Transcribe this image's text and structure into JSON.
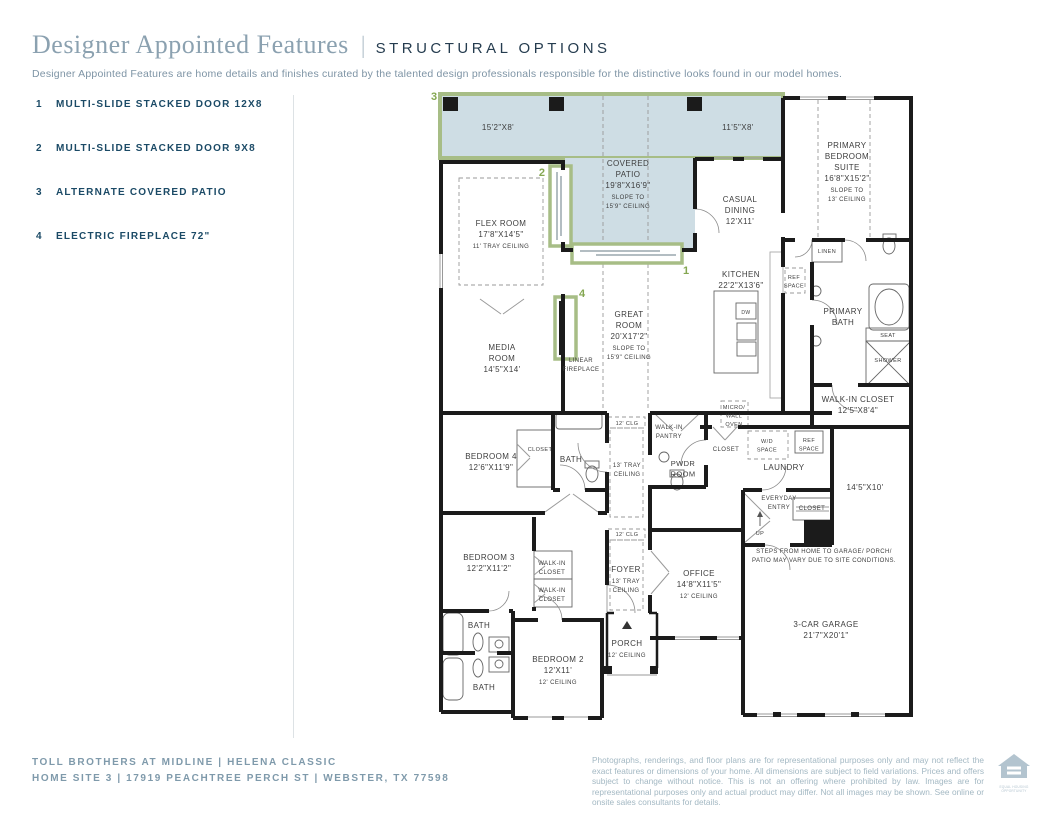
{
  "header": {
    "title": "Designer Appointed Features",
    "divider": "|",
    "tag": "STRUCTURAL OPTIONS",
    "description": "Designer Appointed Features are home details and finishes curated by the talented design professionals responsible for the distinctive looks found in our model homes."
  },
  "legend": {
    "items": [
      {
        "num": "1",
        "label": "MULTI-SLIDE STACKED DOOR 12X8"
      },
      {
        "num": "2",
        "label": "MULTI-SLIDE STACKED DOOR 9X8"
      },
      {
        "num": "3",
        "label": "ALTERNATE COVERED PATIO"
      },
      {
        "num": "4",
        "label": "ELECTRIC FIREPLACE 72\""
      }
    ]
  },
  "footer": {
    "line1": "TOLL BROTHERS AT MIDLINE   |   HELENA CLASSIC",
    "line2": "HOME SITE 3   |   17919 PEACHTREE PERCH ST   |   WEBSTER, TX 77598",
    "disclaimer": "Photographs, renderings, and floor plans are for representational purposes only and may not reflect the exact features or dimensions of your home. All dimensions are subject to field variations. Prices and offers subject to change without notice. This is not an offering where prohibited by law. Images are for representational purposes only and actual product may differ. Not all images may be shown. See online or onsite sales consultants for details.",
    "logo_caption": "EQUAL HOUSING OPPORTUNITY"
  },
  "colors": {
    "accent_navy": "#1b4a66",
    "title_blue": "#8ba1b0",
    "option_green": "#84a751",
    "option_green_border": "#a7bd86",
    "patio_fill": "#cedde4",
    "wall": "#1b1b1b",
    "plan_text": "#3d3d3d"
  },
  "plan": {
    "markers": [
      {
        "n": "1",
        "x": 686,
        "y": 274
      },
      {
        "n": "2",
        "x": 545,
        "y": 176,
        "anchor": "end"
      },
      {
        "n": "3",
        "x": 434,
        "y": 100
      },
      {
        "n": "4",
        "x": 582,
        "y": 297
      }
    ],
    "labels": [
      {
        "id": "alt-patio-left-dim",
        "x": 498,
        "y": 130,
        "lines": [
          "15'2\"X8'"
        ],
        "sizes": [
          8
        ]
      },
      {
        "id": "alt-patio-right-dim",
        "x": 738,
        "y": 130,
        "lines": [
          "11'5\"X8'"
        ],
        "sizes": [
          8
        ]
      },
      {
        "id": "covered-patio",
        "x": 628,
        "y": 166,
        "lines": [
          "COVERED",
          "PATIO",
          "19'8\"X16'9\"",
          "SLOPE TO",
          "15'9\" CEILING"
        ],
        "sizes": [
          8,
          8,
          8,
          6,
          6
        ]
      },
      {
        "id": "flex-room",
        "x": 501,
        "y": 226,
        "lines": [
          "FLEX ROOM",
          "17'8\"X14'5\"",
          "11' TRAY CEILING"
        ],
        "sizes": [
          8,
          8,
          6
        ]
      },
      {
        "id": "casual-dining",
        "x": 740,
        "y": 202,
        "lines": [
          "CASUAL",
          "DINING",
          "12'X11'"
        ],
        "sizes": [
          8,
          8,
          8
        ]
      },
      {
        "id": "primary-bedroom-suite",
        "x": 847,
        "y": 148,
        "lines": [
          "PRIMARY",
          "BEDROOM",
          "SUITE",
          "16'8\"X15'2\"",
          "SLOPE TO",
          "13' CEILING"
        ],
        "sizes": [
          8,
          8,
          8,
          8,
          6,
          6
        ]
      },
      {
        "id": "kitchen",
        "x": 741,
        "y": 277,
        "lines": [
          "KITCHEN",
          "22'2\"X13'6\""
        ],
        "sizes": [
          8,
          8
        ]
      },
      {
        "id": "great-room",
        "x": 629,
        "y": 317,
        "lines": [
          "GREAT",
          "ROOM",
          "20'X17'2\"",
          "SLOPE TO",
          "15'9\" CEILING"
        ],
        "sizes": [
          8,
          8,
          8,
          6,
          6
        ]
      },
      {
        "id": "media-room",
        "x": 502,
        "y": 350,
        "lines": [
          "MEDIA",
          "ROOM",
          "14'5\"X14'"
        ],
        "sizes": [
          8,
          8,
          8
        ]
      },
      {
        "id": "linear-fireplace",
        "x": 581,
        "y": 362,
        "lines": [
          "LINEAR",
          "FIREPLACE"
        ],
        "sizes": [
          6,
          6
        ]
      },
      {
        "id": "linen",
        "x": 827,
        "y": 253,
        "lines": [
          "LINEN"
        ],
        "sizes": [
          5.5
        ]
      },
      {
        "id": "ref-space-kitchen",
        "x": 794,
        "y": 279,
        "lines": [
          "REF",
          "SPACE"
        ],
        "sizes": [
          5.5,
          5.5
        ]
      },
      {
        "id": "primary-bath",
        "x": 843,
        "y": 314,
        "lines": [
          "PRIMARY",
          "BATH"
        ],
        "sizes": [
          8,
          8
        ]
      },
      {
        "id": "seat",
        "x": 888,
        "y": 337,
        "lines": [
          "SEAT"
        ],
        "sizes": [
          5.5
        ]
      },
      {
        "id": "shower",
        "x": 888,
        "y": 362,
        "lines": [
          "SHOWER"
        ],
        "sizes": [
          5.5
        ]
      },
      {
        "id": "walk-in-closet-primary",
        "x": 858,
        "y": 402,
        "lines": [
          "WALK-IN CLOSET",
          "12'5\"X8'4\""
        ],
        "sizes": [
          8,
          8
        ]
      },
      {
        "id": "micro-wall-oven",
        "x": 734,
        "y": 409,
        "lines": [
          "MICRO/",
          "WALL",
          "OVEN"
        ],
        "sizes": [
          5.5,
          5.5,
          5.5
        ]
      },
      {
        "id": "clg-12-upper",
        "x": 627,
        "y": 425,
        "lines": [
          "12' CLG"
        ],
        "sizes": [
          5.5
        ]
      },
      {
        "id": "tray-13-hall",
        "x": 627,
        "y": 467,
        "lines": [
          "13' TRAY",
          "CEILING"
        ],
        "sizes": [
          6,
          6
        ]
      },
      {
        "id": "walk-in-pantry",
        "x": 669,
        "y": 429,
        "lines": [
          "WALK-IN",
          "PANTRY"
        ],
        "sizes": [
          6,
          6
        ]
      },
      {
        "id": "pwdr-room",
        "x": 683,
        "y": 466,
        "lines": [
          "PWDR",
          "ROOM"
        ],
        "sizes": [
          7.5,
          7.5
        ]
      },
      {
        "id": "closet-hall",
        "x": 726,
        "y": 451,
        "lines": [
          "CLOSET"
        ],
        "sizes": [
          6
        ]
      },
      {
        "id": "wd-space",
        "x": 767,
        "y": 443,
        "lines": [
          "W/D",
          "SPACE"
        ],
        "sizes": [
          5.5,
          5.5
        ]
      },
      {
        "id": "ref-space-laundry",
        "x": 809,
        "y": 442,
        "lines": [
          "REF",
          "SPACE"
        ],
        "sizes": [
          5.5,
          5.5
        ]
      },
      {
        "id": "laundry",
        "x": 784,
        "y": 470,
        "lines": [
          "LAUNDRY"
        ],
        "sizes": [
          8
        ]
      },
      {
        "id": "garage-bay-dim",
        "x": 865,
        "y": 490,
        "lines": [
          "14'5\"X10'"
        ],
        "sizes": [
          8
        ]
      },
      {
        "id": "everyday-entry",
        "x": 779,
        "y": 500,
        "lines": [
          "EVERYDAY",
          "ENTRY"
        ],
        "sizes": [
          6,
          6
        ]
      },
      {
        "id": "closet-entry",
        "x": 812,
        "y": 510,
        "lines": [
          "CLOSET"
        ],
        "sizes": [
          6
        ]
      },
      {
        "id": "up",
        "x": 760,
        "y": 535,
        "lines": [
          "UP"
        ],
        "sizes": [
          5.5
        ]
      },
      {
        "id": "bedroom-4",
        "x": 491,
        "y": 459,
        "lines": [
          "BEDROOM 4",
          "12'6\"X11'9\""
        ],
        "sizes": [
          8,
          8
        ]
      },
      {
        "id": "closet-bed4",
        "x": 540,
        "y": 451,
        "lines": [
          "CLOSET"
        ],
        "sizes": [
          5.5
        ]
      },
      {
        "id": "bath-bed4",
        "x": 571,
        "y": 462,
        "lines": [
          "BATH"
        ],
        "sizes": [
          8
        ]
      },
      {
        "id": "steps-note",
        "x": 824,
        "y": 553,
        "lines": [
          "STEPS FROM HOME TO GARAGE/ PORCH/",
          "PATIO MAY VARY DUE TO SITE CONDITIONS."
        ],
        "sizes": [
          6,
          6
        ]
      },
      {
        "id": "bedroom-3",
        "x": 489,
        "y": 560,
        "lines": [
          "BEDROOM 3",
          "12'2\"X11'2\""
        ],
        "sizes": [
          8,
          8
        ]
      },
      {
        "id": "walk-in-closet-bed3-a",
        "x": 552,
        "y": 565,
        "lines": [
          "WALK-IN",
          "CLOSET"
        ],
        "sizes": [
          6,
          6
        ]
      },
      {
        "id": "walk-in-closet-bed3-b",
        "x": 552,
        "y": 592,
        "lines": [
          "WALK-IN",
          "CLOSET"
        ],
        "sizes": [
          6,
          6
        ]
      },
      {
        "id": "foyer",
        "x": 626,
        "y": 572,
        "lines": [
          "FOYER",
          "13' TRAY",
          "CEILING"
        ],
        "sizes": [
          8,
          6,
          6
        ]
      },
      {
        "id": "clg-12-lower",
        "x": 627,
        "y": 536,
        "lines": [
          "12' CLG"
        ],
        "sizes": [
          5.5
        ]
      },
      {
        "id": "office",
        "x": 699,
        "y": 576,
        "lines": [
          "OFFICE",
          "14'8\"X11'5\"",
          "12' CEILING"
        ],
        "sizes": [
          8,
          8,
          6
        ]
      },
      {
        "id": "bath-bed3",
        "x": 479,
        "y": 628,
        "lines": [
          "BATH"
        ],
        "sizes": [
          8
        ]
      },
      {
        "id": "bedroom-2",
        "x": 558,
        "y": 662,
        "lines": [
          "BEDROOM 2",
          "12'X11'",
          "12' CEILING"
        ],
        "sizes": [
          8,
          8,
          6
        ]
      },
      {
        "id": "porch",
        "x": 627,
        "y": 646,
        "lines": [
          "PORCH",
          "12' CEILING"
        ],
        "sizes": [
          8,
          6
        ]
      },
      {
        "id": "bath-bed2",
        "x": 484,
        "y": 690,
        "lines": [
          "BATH"
        ],
        "sizes": [
          8
        ]
      },
      {
        "id": "garage",
        "x": 826,
        "y": 627,
        "lines": [
          "3-CAR GARAGE",
          "21'7\"X20'1\""
        ],
        "sizes": [
          8,
          8
        ]
      },
      {
        "id": "dw",
        "x": 746,
        "y": 314,
        "lines": [
          "DW"
        ],
        "sizes": [
          5
        ]
      }
    ]
  }
}
